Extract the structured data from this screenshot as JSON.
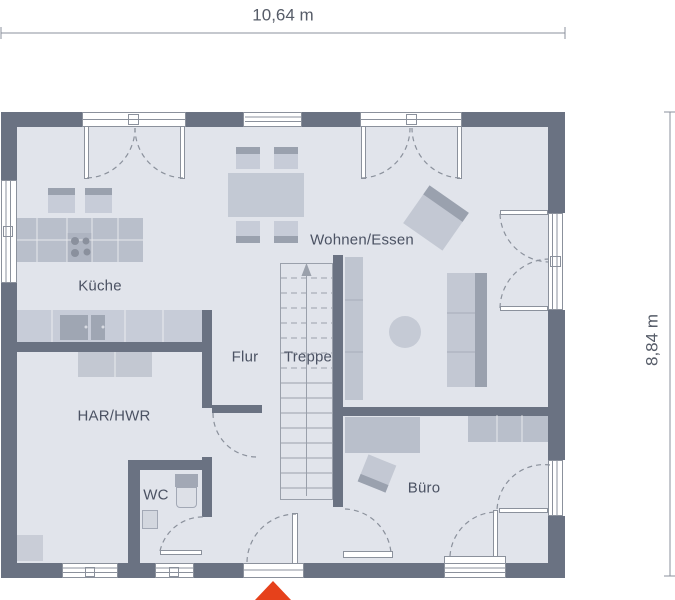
{
  "dimensions": {
    "top": "10,64 m",
    "right": "8,84 m"
  },
  "rooms": {
    "kueche": "Küche",
    "wohnen_essen": "Wohnen/Essen",
    "flur": "Flur",
    "treppe": "Treppe",
    "har_hwr": "HAR/HWR",
    "wc": "WC",
    "buero": "Büro"
  },
  "icons": {
    "entrance_marker": "red-arrow-up",
    "stair_direction": "arrow-up"
  },
  "colors": {
    "wall": "#6a7282",
    "floor": "#e1e4eb",
    "furniture_light": "#c7ccd8",
    "furniture_medium": "#b9bfcb",
    "furniture_dark": "#9aa1ae",
    "outline": "#8b919c",
    "label_text": "#4b5263",
    "entrance_arrow": "#e6411b",
    "background": "#ffffff"
  }
}
